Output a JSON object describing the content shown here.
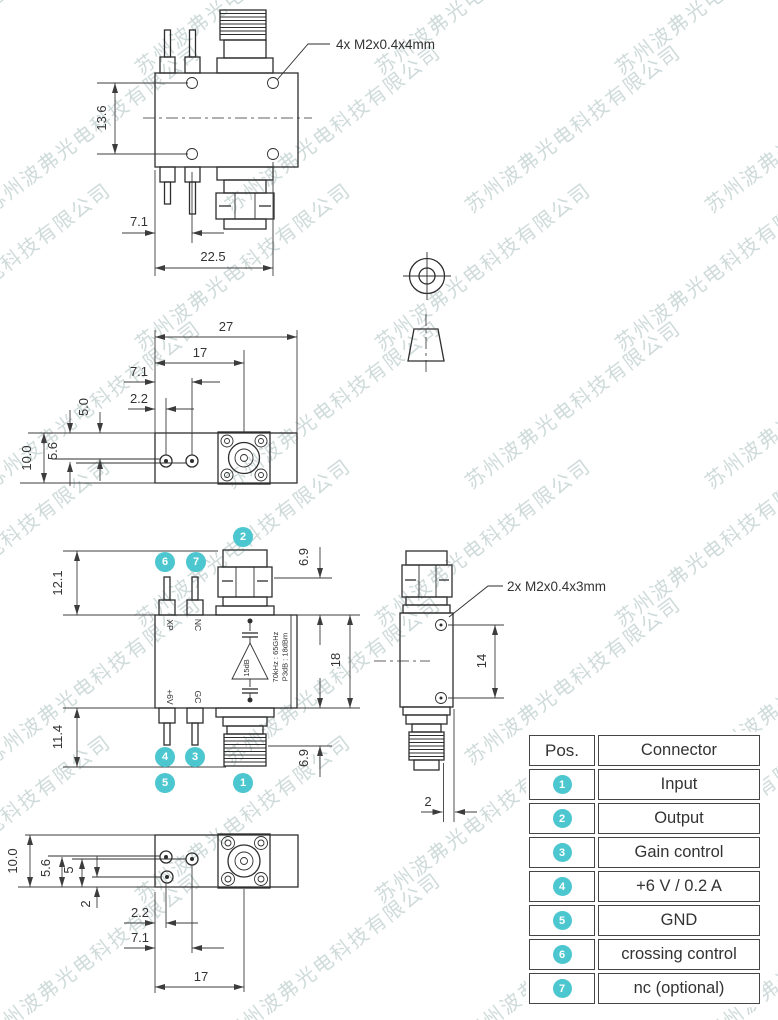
{
  "watermark": {
    "text": "苏州波弗光电科技有限公司",
    "color": "#cfdbda"
  },
  "annotations": {
    "screws4": "4x  M2x0.4x4mm",
    "screws2": "2x  M2x0.4x3mm"
  },
  "views": {
    "top": {
      "dims": {
        "d1": "13.6",
        "d2": "7.1",
        "d3": "22.5"
      }
    },
    "bottomA": {
      "dims": {
        "d1": "27",
        "d2": "17",
        "d3": "7.1",
        "d4": "2.2",
        "d5": "5.0",
        "d6": "5.6",
        "d7": "10.0"
      }
    },
    "front": {
      "dims": {
        "d1": "12.1",
        "d2": "11.4",
        "d3": "6.9",
        "d4": "18",
        "d5": "6.9"
      },
      "pins": {
        "p6": "XP",
        "p7": "NC",
        "p4": "+6V",
        "p3": "GC"
      },
      "amp": {
        "gain": "15dB",
        "spec1": "70kHz : 65GHz",
        "spec2": "P3dB : 18dBm"
      }
    },
    "side": {
      "dims": {
        "d1": "14",
        "d2": "2"
      }
    },
    "bottomB": {
      "dims": {
        "d1": "10.0",
        "d2": "5.6",
        "d3": "5",
        "d4": "2",
        "d5": "2.2",
        "d6": "7.1",
        "d7": "17"
      }
    }
  },
  "callouts": {
    "c1": "1",
    "c2": "2",
    "c3": "3",
    "c4": "4",
    "c5": "5",
    "c6": "6",
    "c7": "7"
  },
  "table": {
    "headers": {
      "pos": "Pos.",
      "connector": "Connector"
    },
    "rows": [
      {
        "pos": "1",
        "label": "Input"
      },
      {
        "pos": "2",
        "label": "Output"
      },
      {
        "pos": "3",
        "label": "Gain control"
      },
      {
        "pos": "4",
        "label": "+6 V / 0.2 A"
      },
      {
        "pos": "5",
        "label": "GND"
      },
      {
        "pos": "6",
        "label": "crossing control"
      },
      {
        "pos": "7",
        "label": "nc (optional)"
      }
    ]
  },
  "colors": {
    "accent": "#4cc7d0",
    "line": "#2e2e2e"
  }
}
